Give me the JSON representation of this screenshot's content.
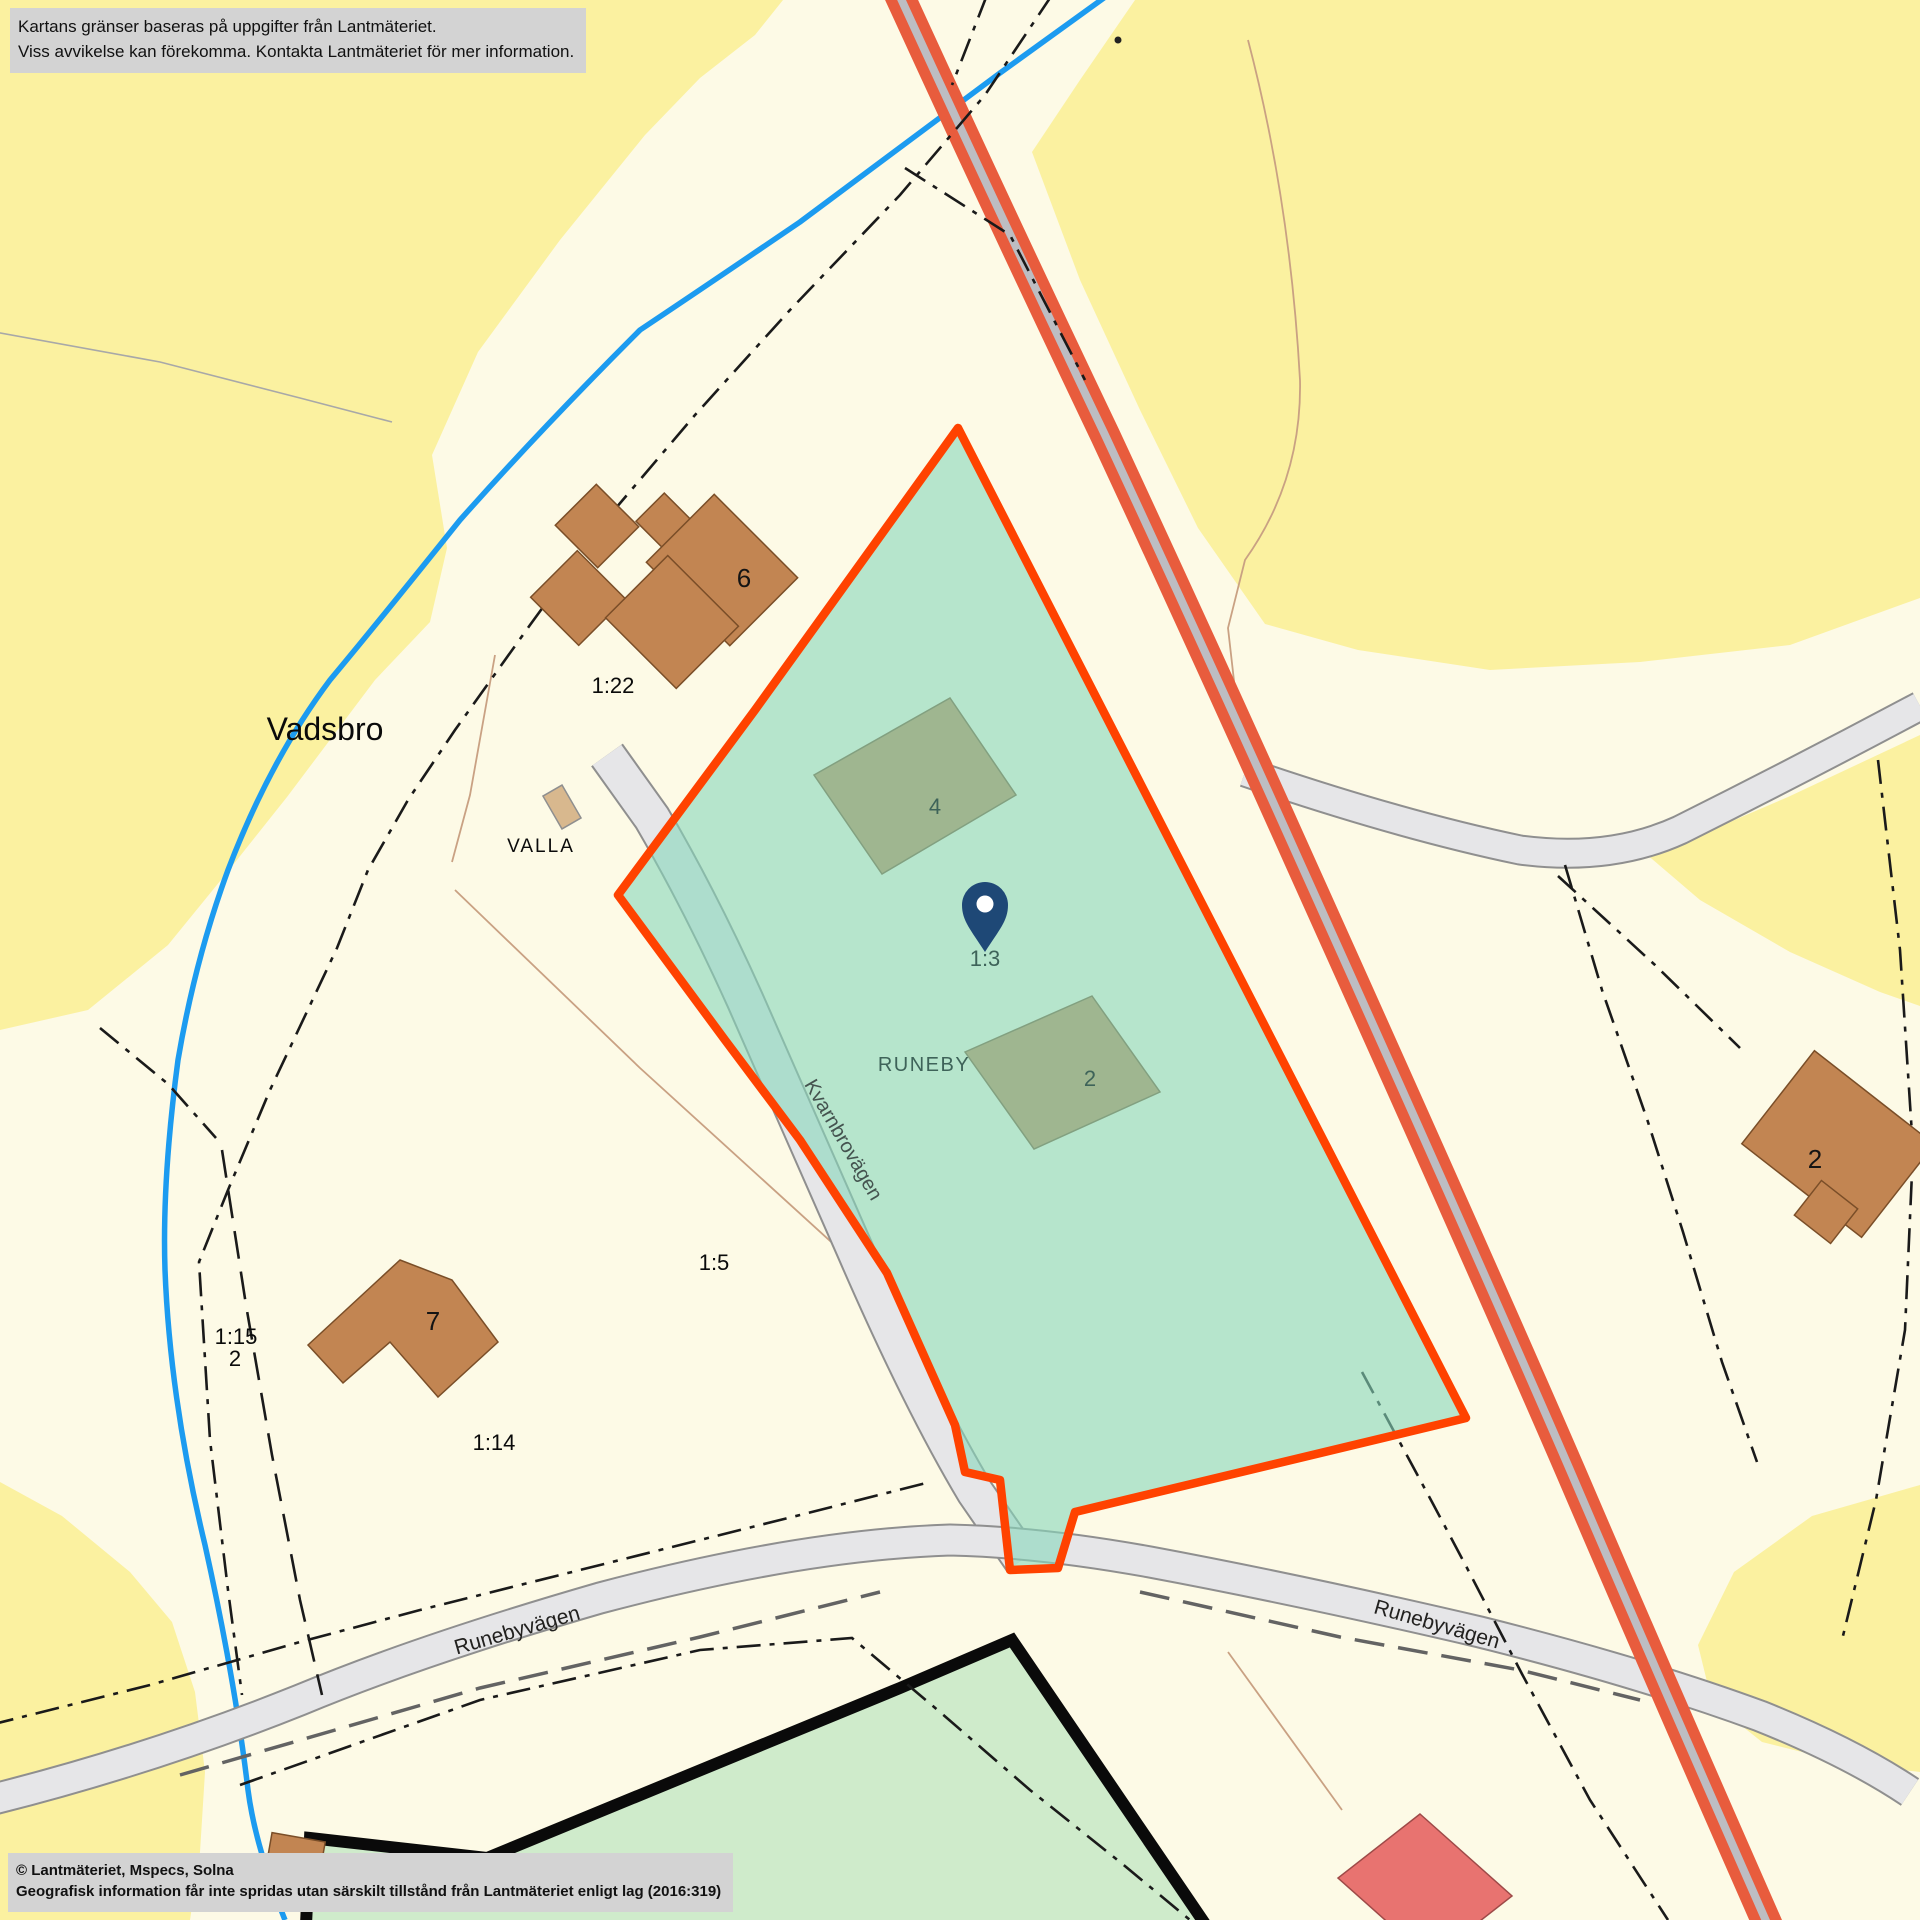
{
  "disclaimer": {
    "line1": "Kartans gränser baseras på uppgifter från Lantmäteriet.",
    "line2": "Viss avvikelse kan förekomma. Kontakta Lantmäteriet för mer information."
  },
  "attribution": {
    "line1": "© Lantmäteriet, Mspecs, Solna",
    "line2": "Geografisk information får inte spridas utan särskilt tillstånd från Lantmäteriet enligt lag (2016:319)"
  },
  "places": {
    "vadsbro": "Vadsbro",
    "valla": "VALLA",
    "runeby": "RUNEBY"
  },
  "parcels": {
    "p1_22": "1:22",
    "p1_5": "1:5",
    "p1_15": "1:15",
    "p1_15_2": "2",
    "p1_14": "1:14",
    "p1_3": "1:3"
  },
  "buildings": {
    "b6": "6",
    "b7": "7",
    "b4": "4",
    "b2_inner": "2",
    "b2_east": "2"
  },
  "roads": {
    "kvarnbrovagen": "Kvarnbrovägen",
    "runebyvagen_west": "Runebyvägen",
    "runebyvagen_east": "Runebyvägen"
  },
  "colors": {
    "land_yellow": "#FBF1A0",
    "parcel_cream": "#FDFAE6",
    "selected_parcel_overlay": "#87D7BB",
    "selected_parcel_border": "#FF4200",
    "building_brown": "#C28552",
    "building_red": "#E87370",
    "road_major_orange": "#E85C3D",
    "road_gray_fill": "#E6E6E8",
    "water_blue": "#1C9BF0",
    "bottom_parcel_green": "#CFEBCB",
    "pin_navy": "#1E4876",
    "notice_bg": "#D3D3D3"
  }
}
